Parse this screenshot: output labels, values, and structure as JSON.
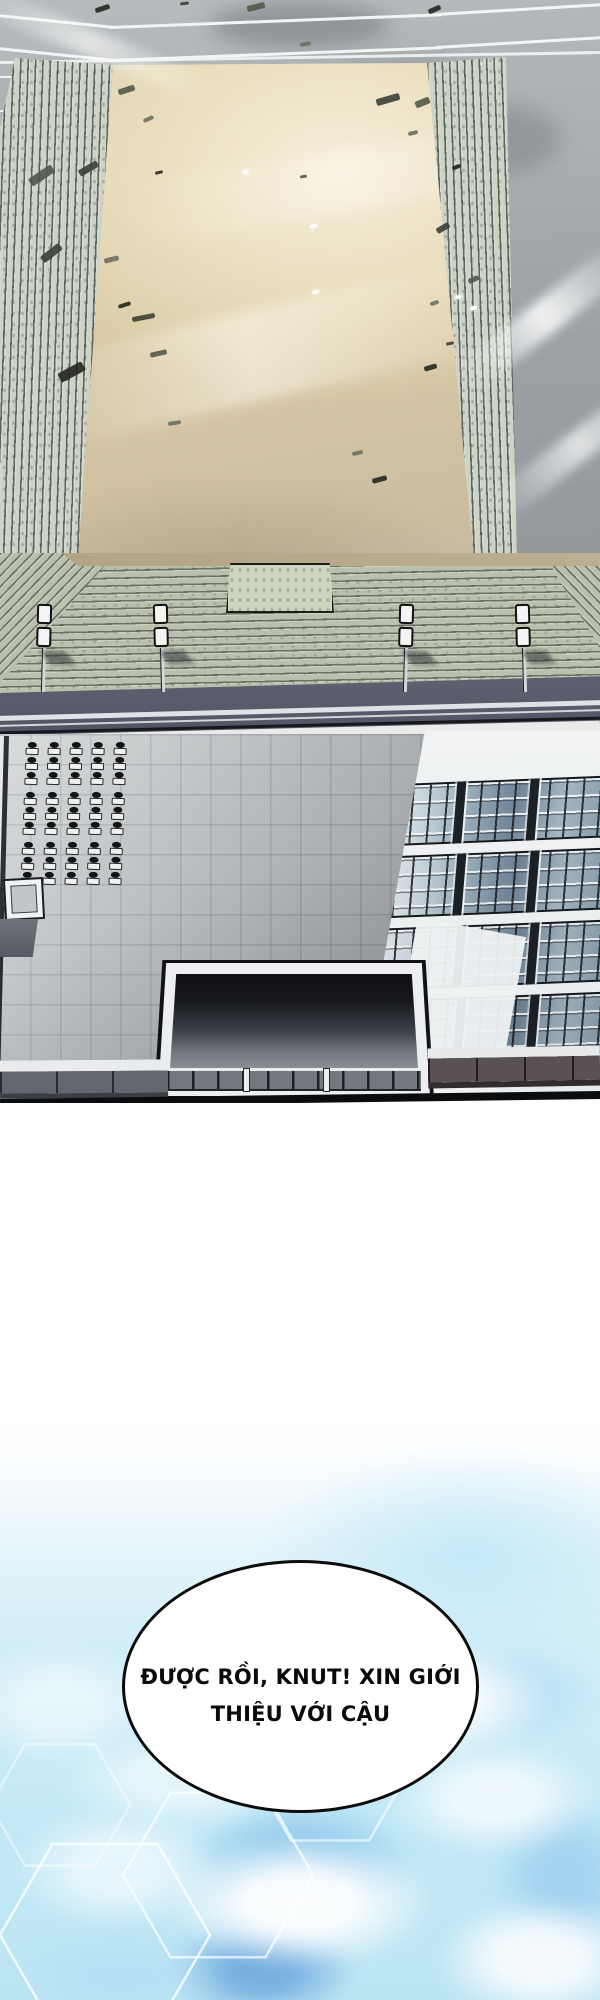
{
  "speech_bubble": {
    "line1": "ĐƯỢC RỒI, KNUT! XIN GIỚI",
    "line2": "THIỆU VỚI CẬU"
  },
  "palette": {
    "sand": "#e3d6b2",
    "frame_gray": "#abb0b3",
    "column_stone": "#cdd3c7",
    "step_stone": "#bac0ad",
    "road": "#585c6a",
    "plaza_tile": "#c2c5c8",
    "glass_light": "#e7edf0",
    "glass_dark": "#6f8496",
    "recess_dark": "#0e1013",
    "sky_cyan": "#c9ecf7",
    "cloud_blue": "#8cc6ec",
    "deep_blue": "#6fa9dd",
    "bubble_fill": "#ffffff",
    "bubble_stroke": "#0c0c0c",
    "ink": "#111111",
    "debris_shades": [
      "#23261f",
      "#3b3f35",
      "#545849",
      "#6b6f60"
    ]
  },
  "scene": {
    "arena": {
      "debris": [
        [
          95,
          6,
          15,
          5,
          -18
        ],
        [
          180,
          2,
          9,
          3,
          -8
        ],
        [
          247,
          4,
          18,
          6,
          -14
        ],
        [
          300,
          42,
          11,
          4,
          -10
        ],
        [
          428,
          7,
          13,
          5,
          -24
        ],
        [
          376,
          96,
          24,
          7,
          -16
        ],
        [
          415,
          99,
          15,
          7,
          -22
        ],
        [
          408,
          131,
          10,
          4,
          -14
        ],
        [
          452,
          165,
          9,
          4,
          -20
        ],
        [
          436,
          225,
          14,
          6,
          -30
        ],
        [
          468,
          277,
          11,
          5,
          -24
        ],
        [
          430,
          301,
          9,
          4,
          -20
        ],
        [
          424,
          365,
          13,
          5,
          -16
        ],
        [
          446,
          342,
          8,
          3,
          -12
        ],
        [
          118,
          87,
          17,
          6,
          -18
        ],
        [
          143,
          117,
          11,
          4,
          -24
        ],
        [
          155,
          171,
          8,
          3,
          -14
        ],
        [
          78,
          165,
          21,
          7,
          -30
        ],
        [
          28,
          171,
          27,
          9,
          -34
        ],
        [
          104,
          257,
          15,
          5,
          -14
        ],
        [
          118,
          303,
          13,
          4,
          -18
        ],
        [
          132,
          315,
          23,
          5,
          -11
        ],
        [
          150,
          351,
          17,
          5,
          -13
        ],
        [
          168,
          421,
          13,
          4,
          -9
        ],
        [
          58,
          367,
          27,
          10,
          -28
        ],
        [
          40,
          249,
          23,
          8,
          -38
        ],
        [
          300,
          175,
          7,
          3,
          -9
        ],
        [
          352,
          451,
          11,
          4,
          -11
        ],
        [
          372,
          477,
          15,
          5,
          -15
        ]
      ],
      "sparkles": [
        [
          242,
          170
        ],
        [
          310,
          224
        ],
        [
          455,
          295
        ],
        [
          470,
          306
        ],
        [
          312,
          290
        ],
        [
          262,
          777
        ],
        [
          152,
          722
        ]
      ],
      "lamps": {
        "xs": [
          32,
          150,
          394,
          512
        ],
        "top": 604
      },
      "desks": {
        "left": 25,
        "top": 741,
        "columns": 5,
        "col_spacing": 22,
        "units_per_column": 9,
        "cluster_size": 3
      },
      "solar": {
        "banks": 4,
        "bank_tops": [
          50,
          122,
          194,
          266
        ],
        "separator_fractions": [
          0.33,
          0.64
        ]
      },
      "railing_post_fractions": [
        0.3,
        0.615
      ]
    },
    "sky": {
      "patches": [
        [
          350,
          350,
          190,
          95,
          "#aadaf4",
          0.85
        ],
        [
          300,
          457,
          230,
          130,
          "#8cc6ec",
          0.9
        ],
        [
          262,
          563,
          190,
          110,
          "#6fa9dd",
          0.9
        ],
        [
          520,
          290,
          170,
          105,
          "#b7e0f5",
          0.8
        ],
        [
          565,
          475,
          150,
          170,
          "#9ed0f0",
          0.85
        ],
        [
          120,
          570,
          210,
          85,
          "#b3ddf4",
          0.7
        ]
      ],
      "clouds": [
        [
          420,
          295,
          270,
          115,
          0.9
        ],
        [
          185,
          373,
          250,
          105,
          0.55
        ],
        [
          300,
          497,
          270,
          135,
          0.95
        ],
        [
          118,
          463,
          210,
          125,
          0.6
        ],
        [
          495,
          393,
          210,
          115,
          0.7
        ],
        [
          540,
          553,
          210,
          125,
          0.85
        ],
        [
          60,
          300,
          200,
          120,
          0.5
        ],
        [
          360,
          235,
          220,
          90,
          0.45
        ]
      ],
      "hexagons": [
        [
          105,
          530,
          105,
          0.8
        ],
        [
          218,
          470,
          95,
          0.7
        ],
        [
          330,
          368,
          78,
          0.6
        ],
        [
          60,
          400,
          70,
          0.45
        ]
      ]
    }
  }
}
